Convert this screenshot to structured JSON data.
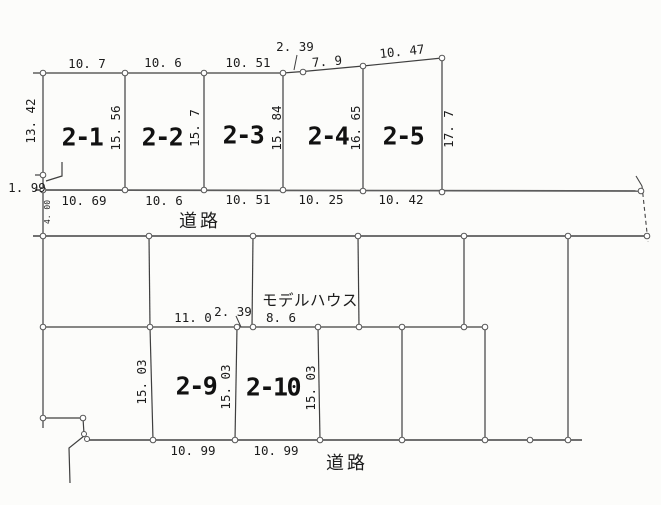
{
  "plots": {
    "p1": "2-1",
    "p2": "2-2",
    "p3": "2-3",
    "p4": "2-4",
    "p5": "2-5",
    "p9": "2-9",
    "p10": "2-10"
  },
  "roads": {
    "top": "道路",
    "bottom": "道路"
  },
  "annotations": {
    "model_house": "モデルハウス"
  },
  "dims": {
    "top_edge": {
      "t1": "10. 7",
      "t2": "10. 6",
      "t3": "10. 51",
      "t4": "2. 39",
      "t5": "7. 9",
      "t6": "10. 47"
    },
    "side_upper": {
      "s0": "13. 42",
      "s1": "15. 56",
      "s2": "15. 7",
      "s3": "15. 84",
      "s4": "16. 65",
      "s5": "17. 7"
    },
    "left_edge": {
      "offset": "1. 99",
      "road_width": "4. 00"
    },
    "bottom_upper": {
      "b1": "10. 69",
      "b2": "10. 6",
      "b3": "10. 51",
      "b4": "10. 25",
      "b5": "10. 42"
    },
    "middle_edge": {
      "m1": "11. 0",
      "m2": "2. 39",
      "m3": "8. 6"
    },
    "side_lower": {
      "s1": "15. 03",
      "s2": "15. 03",
      "s3": "15. 03"
    },
    "bottom_lower": {
      "b1": "10. 99",
      "b2": "10. 99"
    }
  },
  "colors": {
    "boundary_line": "#3f3f3f",
    "road_line": "#5c5c5c",
    "text": "#1c1c1c",
    "background": "#fcfcfa"
  }
}
